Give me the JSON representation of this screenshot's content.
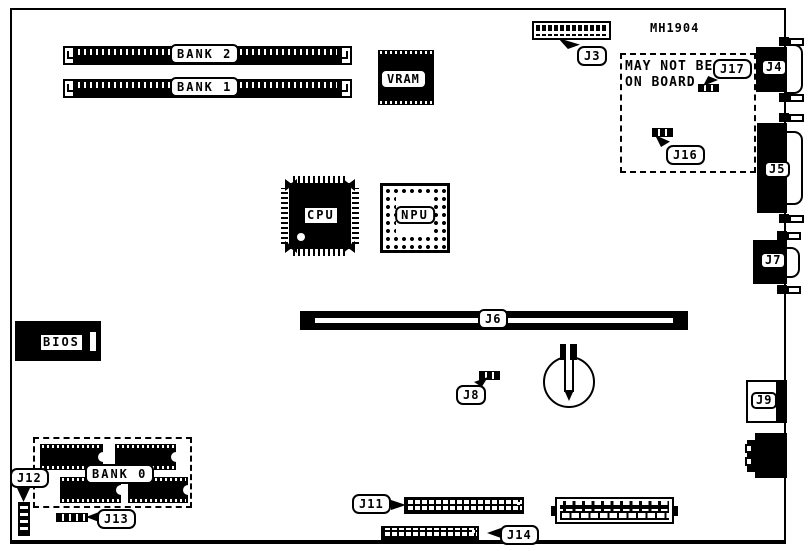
{
  "board": {
    "title": "MH1904",
    "note": {
      "line1": "MAY NOT BE",
      "line2": "ON BOARD"
    },
    "memory": {
      "bank2_label": "BANK 2",
      "bank1_label": "BANK 1",
      "bank0_label": "BANK 0"
    },
    "chips": {
      "cpu": "CPU",
      "npu": "NPU",
      "vram": "VRAM",
      "bios": "BIOS"
    },
    "connectors": {
      "j3": "J3",
      "j4": "J4",
      "j5": "J5",
      "j6": "J6",
      "j7": "J7",
      "j8": "J8",
      "j9": "J9",
      "j11": "J11",
      "j12": "J12",
      "j13": "J13",
      "j14": "J14",
      "j16": "J16",
      "j17": "J17"
    },
    "colors": {
      "ink": "#000000",
      "paper": "#ffffff"
    }
  }
}
